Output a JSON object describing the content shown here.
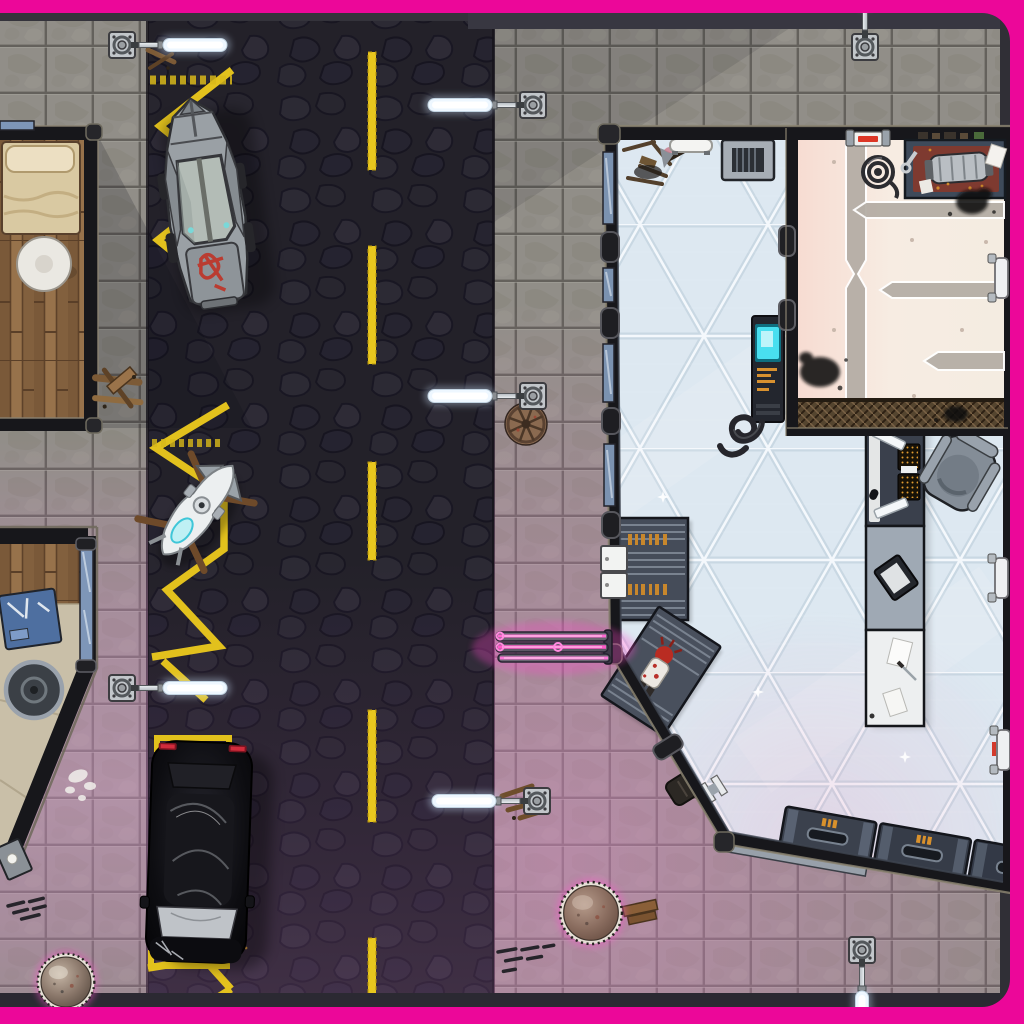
{
  "meta": {
    "title": "cyberpunk-street-battle-map",
    "style": "top-down tabletop/VTT battle map, no UI chrome, no visible text",
    "canvas": {
      "width": 1024,
      "height": 1024
    }
  },
  "palette": {
    "border": "#ec0799",
    "road": "#232129",
    "road_tint": "#8a4f8e",
    "sidewalk": "#918e88",
    "sidewalk_grout": "#64615c",
    "sidewalk_pink": "#d888c8",
    "marking_yellow": "#e8c71e",
    "wall_dark": "#17171b",
    "wall_trim": "#8a8270",
    "glass_floor": "#dde8f1",
    "glass_line": "#f6fbfe",
    "annex_floor_warm": "#f7dcd2",
    "annex_floor_cream": "#f4ece1",
    "accent_bar": "#b5aea6",
    "crate_body": "#3b414d",
    "crate_mark": "#d9912c",
    "neon_pink": "#ff5fd0",
    "console_cyan": "#49dff0",
    "lamp_tube": "#ffffff",
    "wood": "#8c6a46",
    "apc_hull": "#9aa0a5",
    "suv_black": "#0b0b0e",
    "graffiti_red": "#bf3226"
  },
  "scene": {
    "frame": {
      "corner_radius": 30,
      "visible_sides": [
        "top",
        "right",
        "bottom"
      ]
    },
    "road": {
      "x": 148,
      "width": 346,
      "surface": "dark cobbled asphalt",
      "center_dash_x": 368,
      "center_dash_w": 8,
      "dashes": [
        {
          "y": 52,
          "h": 118
        },
        {
          "y": 246,
          "h": 118
        },
        {
          "y": 462,
          "h": 98
        },
        {
          "y": 710,
          "h": 112
        },
        {
          "y": 938,
          "h": 58
        }
      ],
      "zigzag_lane": "left edge keep-clear zigzag",
      "parking_bay": {
        "x1": 151,
        "y1": 738,
        "x2": 229,
        "y2": 966
      }
    },
    "lamps": [
      {
        "id": "street-lamp-1",
        "x": 122,
        "y": 45,
        "angle": 0
      },
      {
        "id": "street-lamp-2",
        "x": 533,
        "y": 105,
        "angle": 180
      },
      {
        "id": "street-lamp-3",
        "x": 533,
        "y": 396,
        "angle": 180
      },
      {
        "id": "street-lamp-4",
        "x": 122,
        "y": 688,
        "angle": 0
      },
      {
        "id": "street-lamp-5",
        "x": 537,
        "y": 801,
        "angle": 180
      },
      {
        "id": "street-lamp-6",
        "x": 865,
        "y": 47,
        "angle": -90
      },
      {
        "id": "street-lamp-7",
        "x": 862,
        "y": 950,
        "angle": 90
      }
    ],
    "domes": [
      {
        "id": "manhole-dome-1",
        "x": 66,
        "y": 982,
        "s": 0.96
      },
      {
        "id": "manhole-dome-2",
        "x": 591,
        "y": 913,
        "s": 1.05
      }
    ],
    "vehicles": [
      {
        "proto": "proto-apc",
        "name": "armored-truck",
        "x": 205,
        "y": 202,
        "r": -8
      },
      {
        "proto": "proto-bike",
        "name": "hover-bike",
        "x": 198,
        "y": 510,
        "r": 38
      },
      {
        "proto": "proto-suv",
        "name": "black-suv",
        "x": 199,
        "y": 852,
        "r": 2
      }
    ],
    "buildings": [
      {
        "name": "apartment-room",
        "side": "left-top",
        "floor": "wood planks",
        "furniture": [
          "bed",
          "round-table"
        ]
      },
      {
        "name": "corner-shop",
        "side": "left-bottom",
        "floor": "wood + tan stone",
        "furniture": [
          "blue-tool-desk",
          "round-table",
          "side-table"
        ],
        "window": "blue glass strip"
      },
      {
        "name": "showroom-hall",
        "side": "right",
        "floor": "white-blue triangulated glass",
        "furniture": [
          "debris-pile",
          "white-bench",
          "vent-crate",
          "cyan-console",
          "hose-coil",
          "shelf-rack-a",
          "shelf-rack-b-with-figure",
          "work-desk",
          "long-counter",
          "armchair",
          "cargo-crates"
        ]
      },
      {
        "name": "machine-annex",
        "side": "right-top",
        "floor": "cream metal panels",
        "furniture": [
          "workbench-with-engine",
          "cable-coil",
          "scorch-marks",
          "red-door",
          "floor-grate"
        ]
      }
    ],
    "street_props": [
      "neon-bench",
      "round-vent-fan",
      "wood-debris-piles",
      "sewer-grates",
      "white-paint-splat",
      "parking-markings"
    ]
  }
}
